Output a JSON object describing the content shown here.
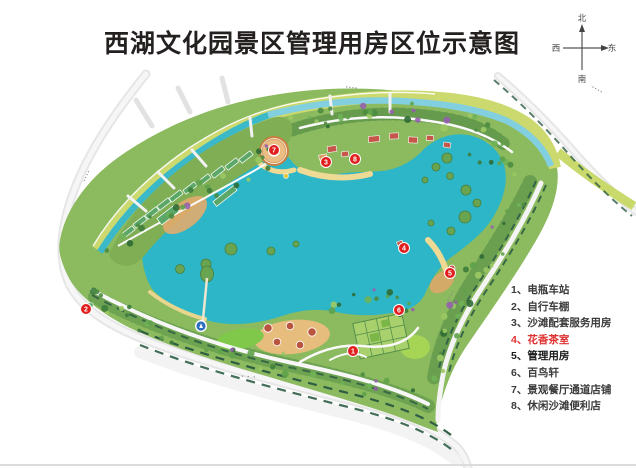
{
  "title": "西湖文化园景区管理用房区位示意图",
  "compass": {
    "north": "北",
    "south": "南",
    "east": "东",
    "west": "西"
  },
  "legend": {
    "items": [
      {
        "text": "1、电瓶车站",
        "color": "#3b3b3b",
        "bold": false
      },
      {
        "text": "2、自行车棚",
        "color": "#3b3b3b",
        "bold": false
      },
      {
        "text": "3、沙滩配套服务用房",
        "color": "#3b3b3b",
        "bold": false
      },
      {
        "text": "4、花香茶室",
        "color": "#e03030",
        "bold": true
      },
      {
        "text": "5、管理用房",
        "color": "#1c1c1c",
        "bold": true
      },
      {
        "text": "6、百鸟轩",
        "color": "#3b3b3b",
        "bold": false
      },
      {
        "text": "7、景观餐厅通道店铺",
        "color": "#3b3b3b",
        "bold": false
      },
      {
        "text": "8、休闲沙滩便利店",
        "color": "#3b3b3b",
        "bold": false
      }
    ]
  },
  "map": {
    "marker_color": "#e21f1f",
    "markers": [
      {
        "n": "1",
        "x": 353,
        "y": 351
      },
      {
        "n": "2",
        "x": 86,
        "y": 309
      },
      {
        "n": "3",
        "x": 326,
        "y": 162
      },
      {
        "n": "4",
        "x": 404,
        "y": 248
      },
      {
        "n": "5",
        "x": 450,
        "y": 273
      },
      {
        "n": "6",
        "x": 399,
        "y": 310
      },
      {
        "n": "7",
        "x": 274,
        "y": 150
      },
      {
        "n": "8",
        "x": 355,
        "y": 159
      }
    ],
    "road_labels": [
      {
        "text": "▪▪▪▪",
        "x": 88,
        "y": 176,
        "rot": -65
      },
      {
        "text": "▪▪▪▪",
        "x": 352,
        "y": 89,
        "rot": 7
      },
      {
        "text": "▪▪▪▪",
        "x": 597,
        "y": 91,
        "rot": 30
      },
      {
        "text": "▪▪▪▪",
        "x": 452,
        "y": 296,
        "rot": -60
      },
      {
        "text": "▪ ▪ ▪",
        "x": 249,
        "y": 378,
        "rot": 4
      }
    ],
    "badge": {
      "x": 201,
      "y": 326,
      "color": "#2f6fc0"
    },
    "colors": {
      "lake": "#2db6c7",
      "park": "#8cba5f",
      "canal": "#82cfdf",
      "bank": "#cbd96e",
      "sand": "#eed995",
      "road": "#e6e6e6",
      "hedge": "#2e5d44"
    }
  }
}
